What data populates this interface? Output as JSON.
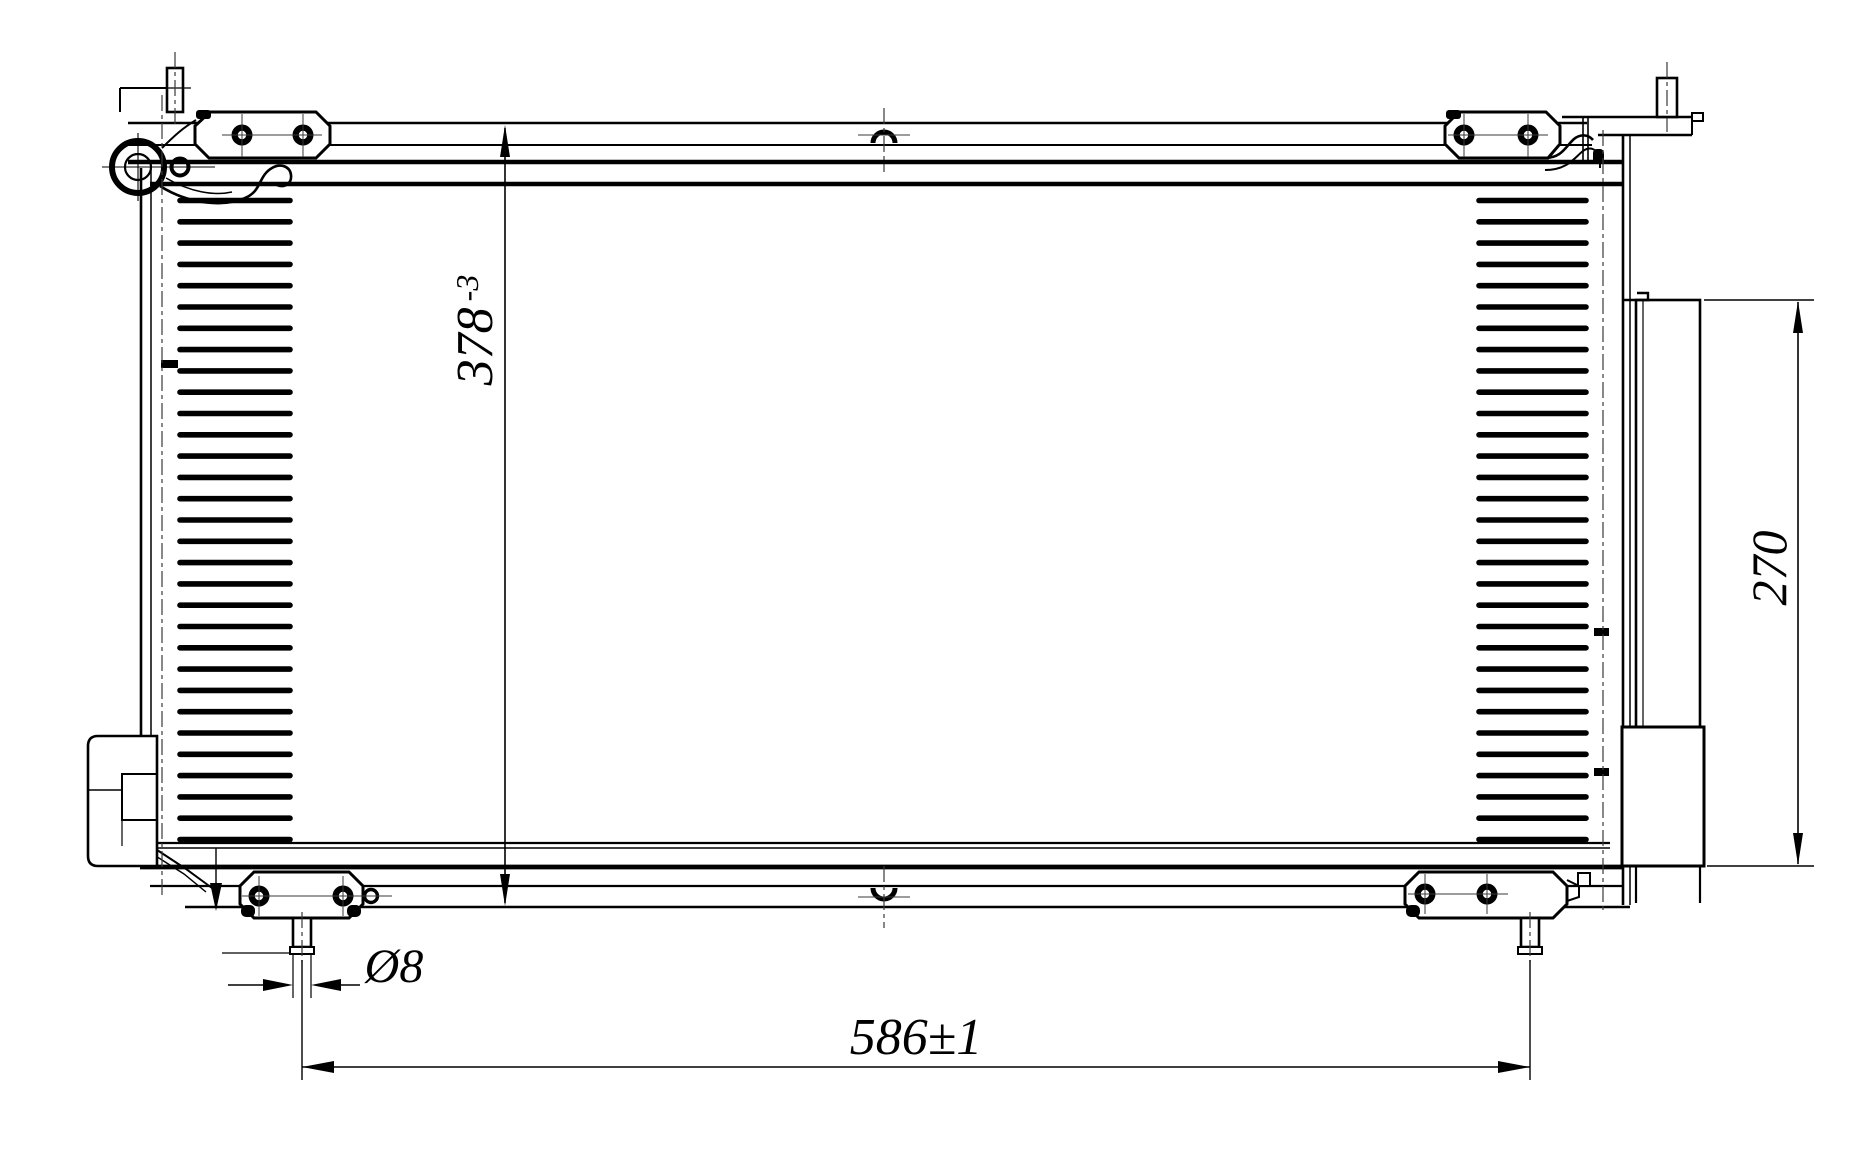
{
  "drawing": {
    "type": "engineering-drawing",
    "subject": "automotive condenser front view",
    "colors": {
      "background": "#ffffff",
      "line": "#000000",
      "centerline": "#3a3a3a"
    }
  },
  "labels": {
    "core_height_value": "378",
    "core_height_tolerance": "-3",
    "drier_height": "270",
    "mounting_span": "586±1",
    "pin_diameter": "Ø8"
  }
}
